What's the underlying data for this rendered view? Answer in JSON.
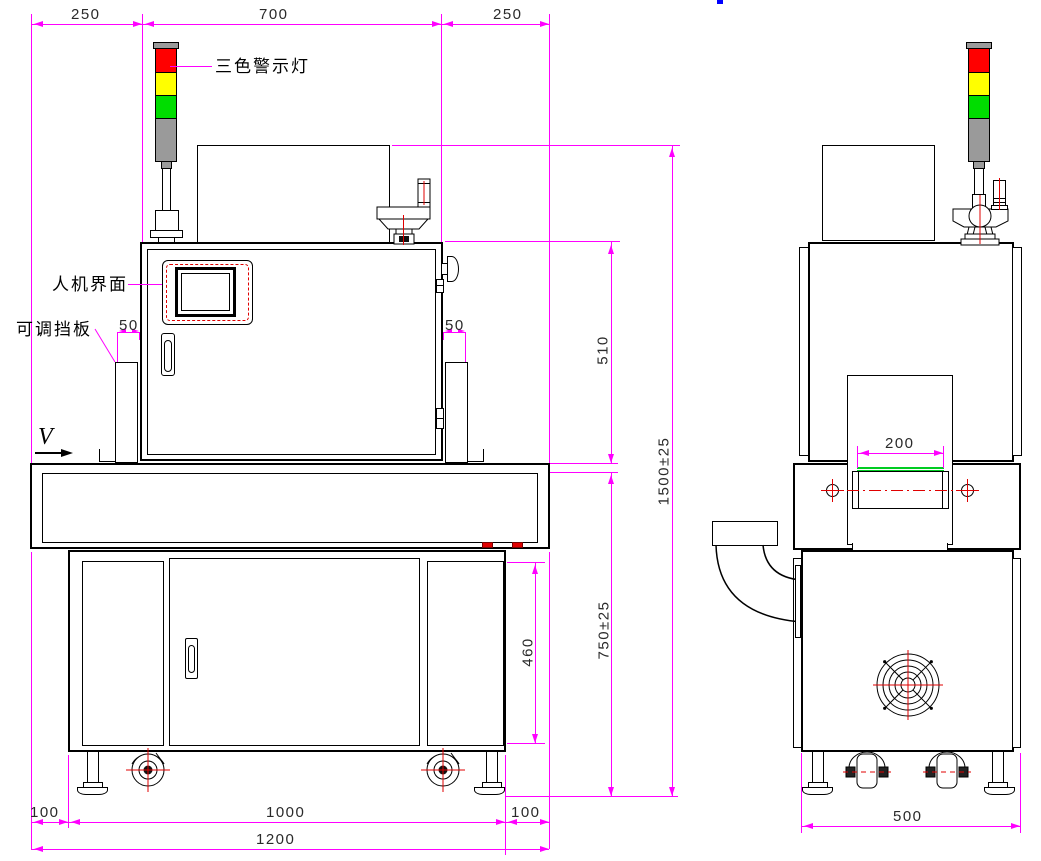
{
  "labels": {
    "warning_light": "三色警示灯",
    "hmi": "人机界面",
    "adjustable_baffle": "可调挡板",
    "view_marker": "V"
  },
  "front_dims": {
    "top_left": "250",
    "top_center": "700",
    "top_right": "250",
    "baffle_gap_left": "50",
    "baffle_gap_right": "50",
    "head_height": "510",
    "total_height": "1500±25",
    "table_height": "750±25",
    "door_height": "460",
    "bottom_left": "100",
    "bottom_center": "1000",
    "bottom_right": "100",
    "bottom_total": "1200"
  },
  "side_dims": {
    "belt_width": "200",
    "base_width": "500"
  },
  "colors": {
    "dimension": "#ff00ff",
    "centerline_red": "#e00000",
    "lamp_red": "#ff0000",
    "lamp_yellow": "#ffff00",
    "lamp_green": "#00dd00",
    "lamp_gray": "#9a9a9a",
    "belt_green": "#00cc22",
    "outline": "#000000",
    "cursor_blue": "#0000ff"
  }
}
